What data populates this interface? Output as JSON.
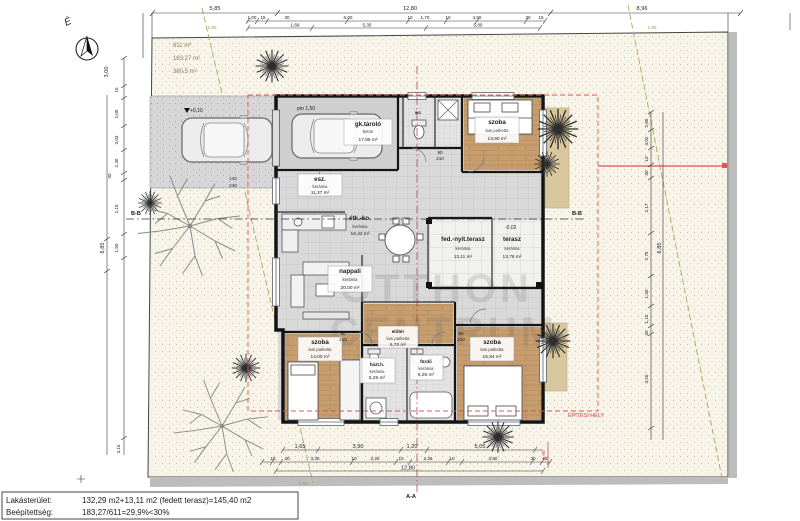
{
  "north": {
    "label": "É"
  },
  "site": {
    "areas": [
      "611 m²",
      "183,27 m²",
      "380,5 m²"
    ],
    "boundary_dim_labels": [
      "1,90",
      "1,90",
      "1,90"
    ],
    "building_envelope_label": "ÉPÍTÉSI HELY"
  },
  "watermark": {
    "line1": "OTTHON",
    "line2": "CENTRUM"
  },
  "rooms": [
    {
      "name": "gk.tároló",
      "floor": "beton",
      "area": "17,85 m²"
    },
    {
      "name": "esz.",
      "floor": "kerámia",
      "area": "11,37 m²"
    },
    {
      "name": "étk.-ko.",
      "floor": "kerámia",
      "area": "16,42 m²"
    },
    {
      "name": "nappali",
      "floor": "kerámia",
      "area": "20,00 m²"
    },
    {
      "name": "fed.-nyit.terasz",
      "floor": "kerámia",
      "area": "13,11 m²"
    },
    {
      "name": "terasz",
      "floor": "kerámia",
      "area": "13,76 m²"
    },
    {
      "name": "szoba",
      "floor": "lam.parketta",
      "area": "13,90 m²"
    },
    {
      "name": "szoba",
      "floor": "lam.parketta",
      "area": "14,00 m²"
    },
    {
      "name": "házt.h.",
      "floor": "kerámia",
      "area": "5,25 m²"
    },
    {
      "name": "fürdő",
      "floor": "kerámia",
      "area": "6,25 m²"
    },
    {
      "name": "szoba",
      "floor": "lam.parketta",
      "area": "15,84 m²"
    },
    {
      "name": "előtér",
      "floor": "lam.parketta",
      "area": "6,70 m²"
    },
    {
      "name": "wc"
    }
  ],
  "levels": {
    "driveway": "+0,10",
    "terrace": "-0,02",
    "parapet": "pm 1,50"
  },
  "sections": {
    "aa": "A-A",
    "bb": "B-B"
  },
  "dims": {
    "top_row1": [
      "5,85",
      "12,80",
      "8,96"
    ],
    "top_row2": [
      "1,00",
      "15",
      "30",
      "6,00",
      "10",
      "1,70",
      "10",
      "4,00",
      "30",
      "15"
    ],
    "top_row3": [
      "1,68",
      "5,35",
      "5,80"
    ],
    "bottom_row1": [
      "1,65",
      "3,90",
      "1,20",
      "5,05"
    ],
    "bottom_row2": [
      "15",
      "30",
      "3,30",
      "10",
      "2,25",
      "10",
      "2,25",
      "10",
      "3,80",
      "30",
      "15"
    ],
    "bottom_total": "12,80",
    "left": [
      "3,00",
      "15",
      "2,05",
      "3,03",
      "2,40",
      "30",
      "2,15",
      "1,50",
      "6,85",
      "3,15"
    ],
    "right": [
      "2,60",
      "3,02",
      "10",
      "30",
      "2,17",
      "2,70",
      "6,85",
      "1,30",
      "1,10",
      "30",
      "4,20"
    ],
    "red_setback": "1,90",
    "openings": [
      "90",
      "210",
      "140",
      "240"
    ]
  },
  "infobox": {
    "row1_label": "Lakásterület:",
    "row1_value": "132,29 m2+13,11 m2 (fedett terasz)=145,40 m2",
    "row2_label": "Beépítettség:",
    "row2_value": "183,27/611=29,9%<30%"
  },
  "colors": {
    "red_accent": "#cf4040",
    "tan_boundary": "#b3945f",
    "wood_floor": "#c69d6e",
    "site_fill": "#f7f4ea"
  }
}
